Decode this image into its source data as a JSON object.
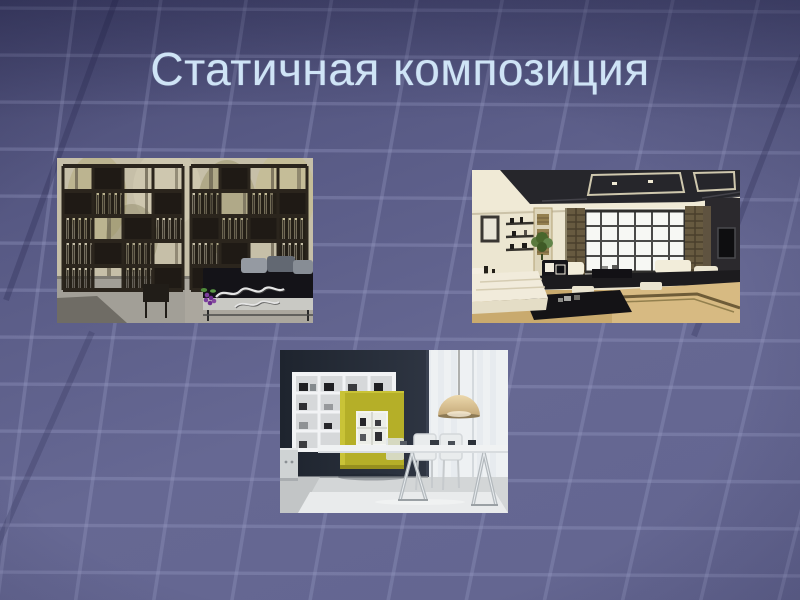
{
  "slide": {
    "title": "Статичная композиция",
    "title_color": "#cfe4f6"
  },
  "background": {
    "base_color": "#62648f",
    "grid_line_color": "#9ba0c6",
    "dark_accent_color": "#2e2f55"
  },
  "colors": {
    "accent_chartreuse": "#b5af28",
    "photo_dark_wall": "#242b38",
    "photo_cream": "#ece6d1"
  },
  "photos": [
    {
      "name": "bookshelf-room-divider",
      "description": "Открытый стеллаж-перегородка с книгами и кроватью у окна"
    },
    {
      "name": "japanese-living-room",
      "description": "Гостиная в японском стиле с кессонным потолком и большим окном"
    },
    {
      "name": "modern-interior-yellow-cabinet",
      "description": "Современный интерьер с белым стеллажом, жёлтым шкафом, столом и подвесным светильником"
    }
  ]
}
